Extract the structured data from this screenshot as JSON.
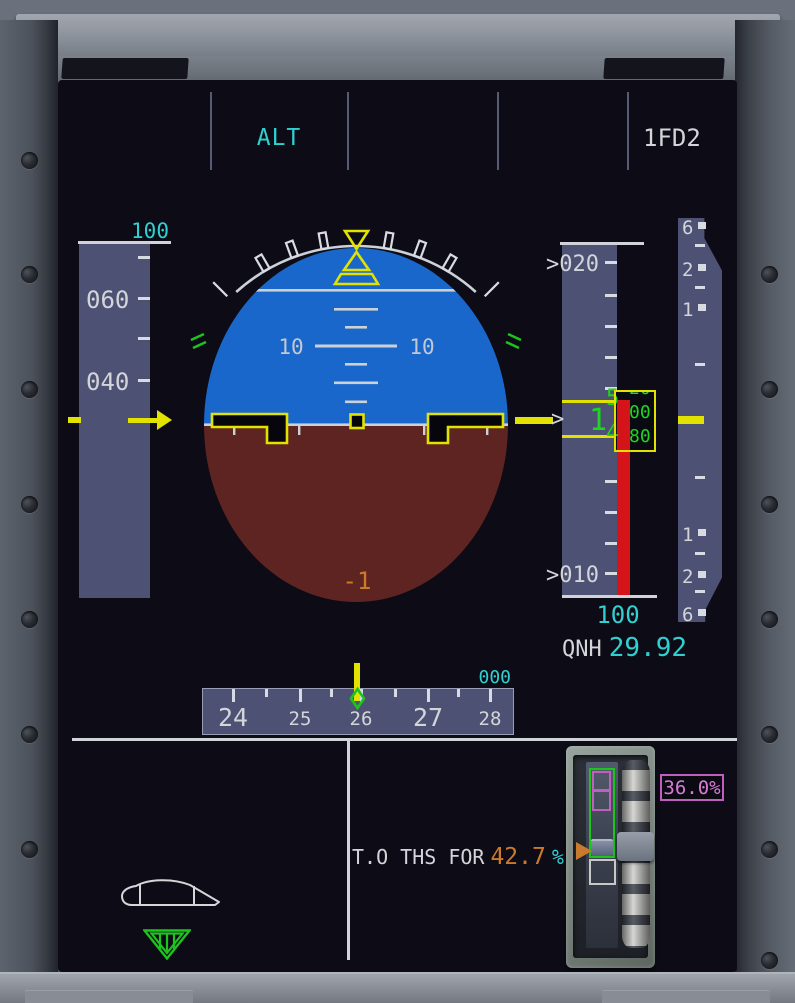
{
  "fma": {
    "vertical_mode": "ALT",
    "fd_status": "1FD2"
  },
  "speed_tape": {
    "selected_speed": "100",
    "labels": [
      "060",
      "040"
    ]
  },
  "attitude": {
    "pitch_label_left": "10",
    "pitch_label_right": "10",
    "pitch_readout": "-1"
  },
  "altitude_tape": {
    "labels": [
      ">020",
      ">010"
    ],
    "readout": {
      "thousands": "1",
      "hundreds_upper": "5",
      "hundreds_lower": "4",
      "drum": [
        "20",
        "00",
        "80",
        "60"
      ]
    },
    "target_chevron": ">",
    "selected_altitude": "100",
    "qnh_label": "QNH",
    "qnh_value": "29.92"
  },
  "vs_scale": {
    "labels_up": [
      "6",
      "2",
      "1"
    ],
    "labels_down": [
      "1",
      "2",
      "6"
    ]
  },
  "heading_tape": {
    "labels": [
      "24",
      "25",
      "26",
      "27",
      "28"
    ],
    "selected_heading": "000"
  },
  "trim": {
    "message_prefix": "T.O THS FOR",
    "ths_target_value": "42.7",
    "ths_target_unit": "%",
    "ths_position_readout": "36.0%"
  },
  "colors": {
    "cyan": "#2fd0d0",
    "green": "#1fd51f",
    "yellow": "#e2e200",
    "amber": "#cc7a28",
    "magenta": "#d77bd7",
    "red": "#d41418",
    "sky_blue": "#1a67cb",
    "ground_brown": "#5e2421",
    "tape_background": "#4d5275"
  }
}
